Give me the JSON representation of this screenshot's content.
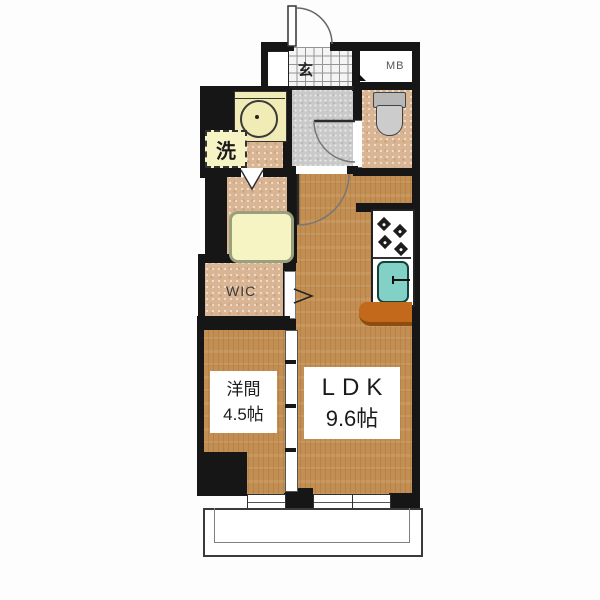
{
  "floorplan": {
    "entrance": {
      "label": "玄"
    },
    "meter_box": {
      "label": "MB"
    },
    "washer_space": {
      "label": "洗"
    },
    "walk_in_closet": {
      "label": "WIC"
    },
    "western_room": {
      "name": "洋間",
      "area": "4.5帖"
    },
    "ldk": {
      "name": "LDK",
      "area": "9.6帖"
    },
    "colors": {
      "wood_floor": "#c28e52",
      "tile_floor": "#d9b593",
      "hallway_floor": "#c9c9c9",
      "bathtub": "#f5f4c2",
      "kitchen_sink": "#82d0c6",
      "kitchen_counter": "#c2691b",
      "vanity": "#f1ecb6",
      "wall": "#161616"
    }
  }
}
